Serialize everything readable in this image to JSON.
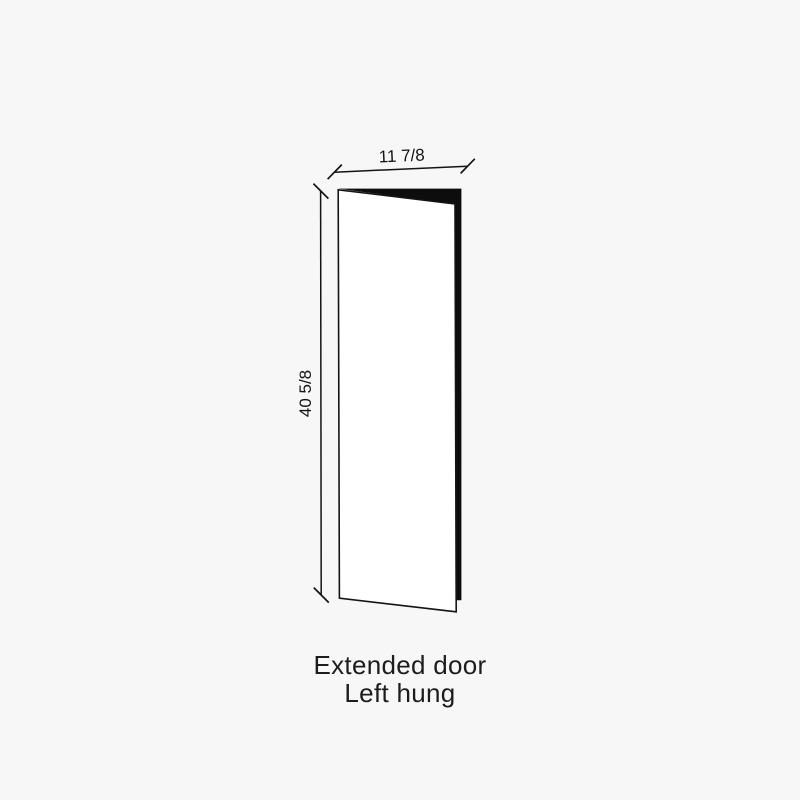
{
  "diagram": {
    "type": "door-elevation-drawing",
    "width_label": "11 7/8",
    "height_label": "40 5/8"
  },
  "caption": {
    "line1": "Extended door",
    "line2": "Left hung"
  },
  "colors": {
    "background": "#f7f7f7",
    "line": "#141414",
    "panel_fill": "#ffffff",
    "edge_fill": "#0d0d0d",
    "caption_text": "#1d1d1d"
  }
}
